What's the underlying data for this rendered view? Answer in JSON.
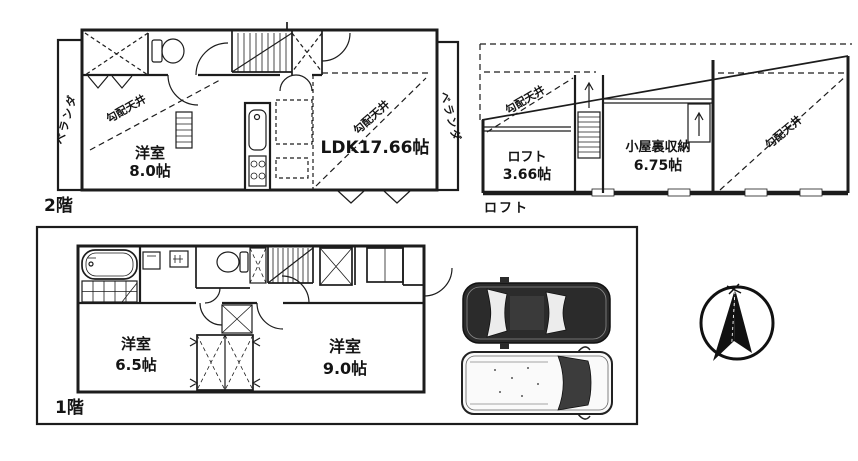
{
  "floor2": {
    "label": "2階",
    "veranda": "ベランダ",
    "sloped_ceiling": "勾配天井",
    "room_west": {
      "name": "洋室",
      "size": "8.0帖"
    },
    "ldk": {
      "label": "LDK17.66帖"
    }
  },
  "loft": {
    "label": "ロフト",
    "sloped_ceiling": "勾配天井",
    "room_loft": {
      "name": "ロフト",
      "size": "3.66帖"
    },
    "room_attic": {
      "name": "小屋裏収納",
      "size": "6.75帖"
    }
  },
  "floor1": {
    "label": "1階",
    "room_west": {
      "name": "洋室",
      "size": "6.5帖"
    },
    "room_east": {
      "name": "洋室",
      "size": "9.0帖"
    }
  },
  "icons": {
    "compass": "north-arrow-compass",
    "car_top": "car-top-view",
    "fixtures": [
      "toilet",
      "bathtub",
      "kitchen-counter",
      "stairs",
      "ladder",
      "washer",
      "basin"
    ]
  },
  "colors": {
    "line": "#1c1c1c",
    "background": "#ffffff",
    "car_dark": "#2b2b2b",
    "glass": "#ececec"
  }
}
